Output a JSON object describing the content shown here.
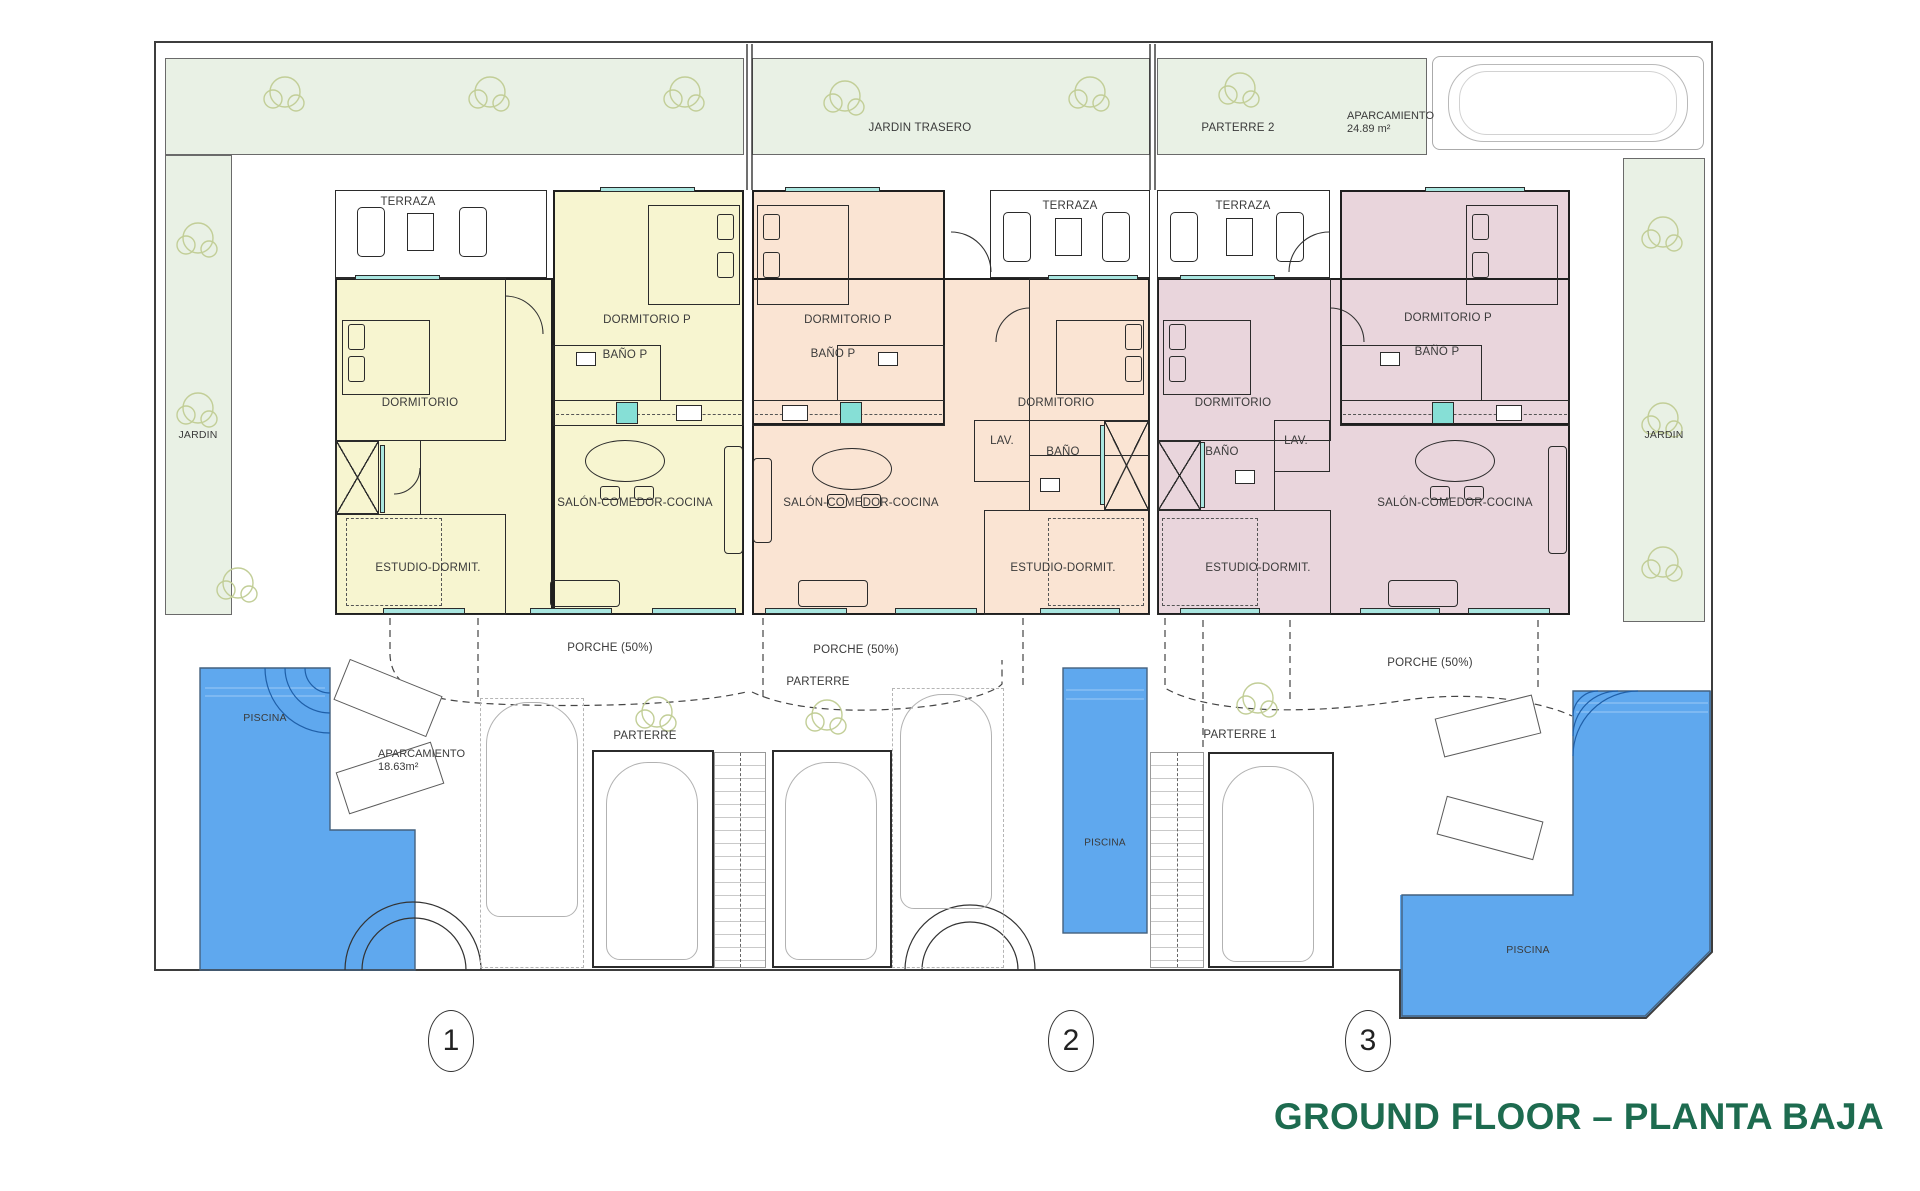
{
  "title": {
    "text": "GROUND FLOOR – PLANTA BAJA"
  },
  "site": {
    "jardin_trasero": "JARDIN TRASERO",
    "parterre_2": "PARTERRE 2",
    "aparcamiento_top": {
      "name": "APARCAMIENTO",
      "area": "24.89 m²"
    },
    "jardin_left": "JARDIN",
    "jardin_right": "JARDIN",
    "aparcamiento_left": {
      "name": "APARCAMIENTO",
      "area": "18.63m²"
    },
    "parterre_center_a": "PARTERRE",
    "parterre_center_b": "PARTERRE",
    "parterre_1": "PARTERRE 1",
    "piscina_left": "PISCINA",
    "piscina_center": "PISCINA",
    "piscina_right": "PISCINA"
  },
  "units": [
    {
      "number": "1",
      "rooms": {
        "terraza": "TERRAZA",
        "dormitorio_p": "DORMITORIO P",
        "bano_p": "BAÑO P",
        "dormitorio": "DORMITORIO",
        "salon": "SALÓN-COMEDOR-COCINA",
        "estudio": "ESTUDIO-DORMIT.",
        "porche": "PORCHE (50%)"
      }
    },
    {
      "number": "2",
      "rooms": {
        "terraza": "TERRAZA",
        "dormitorio_p": "DORMITORIO P",
        "bano_p": "BAÑO P",
        "dormitorio": "DORMITORIO",
        "lav": "LAV.",
        "bano": "BAÑO",
        "salon": "SALÓN-COMEDOR-COCINA",
        "estudio": "ESTUDIO-DORMIT.",
        "porche": "PORCHE (50%)"
      }
    },
    {
      "number": "3",
      "rooms": {
        "terraza": "TERRAZA",
        "dormitorio_p": "DORMITORIO P",
        "bano_p": "BAÑO P",
        "dormitorio": "DORMITORIO",
        "lav": "LAV.",
        "bano": "BAÑO",
        "salon": "SALÓN-COMEDOR-COCINA",
        "estudio": "ESTUDIO-DORMIT.",
        "porche": "PORCHE (50%)"
      }
    }
  ],
  "colors": {
    "unit1_fill": "#F7F5D0",
    "unit2_fill": "#FAE4D3",
    "unit3_fill": "#E9D5DC",
    "pool_blue": "#5FA8EE",
    "garden_green": "#E9F1E5",
    "window_teal": "#A9E6E0",
    "title_green": "#1D6B4F"
  }
}
